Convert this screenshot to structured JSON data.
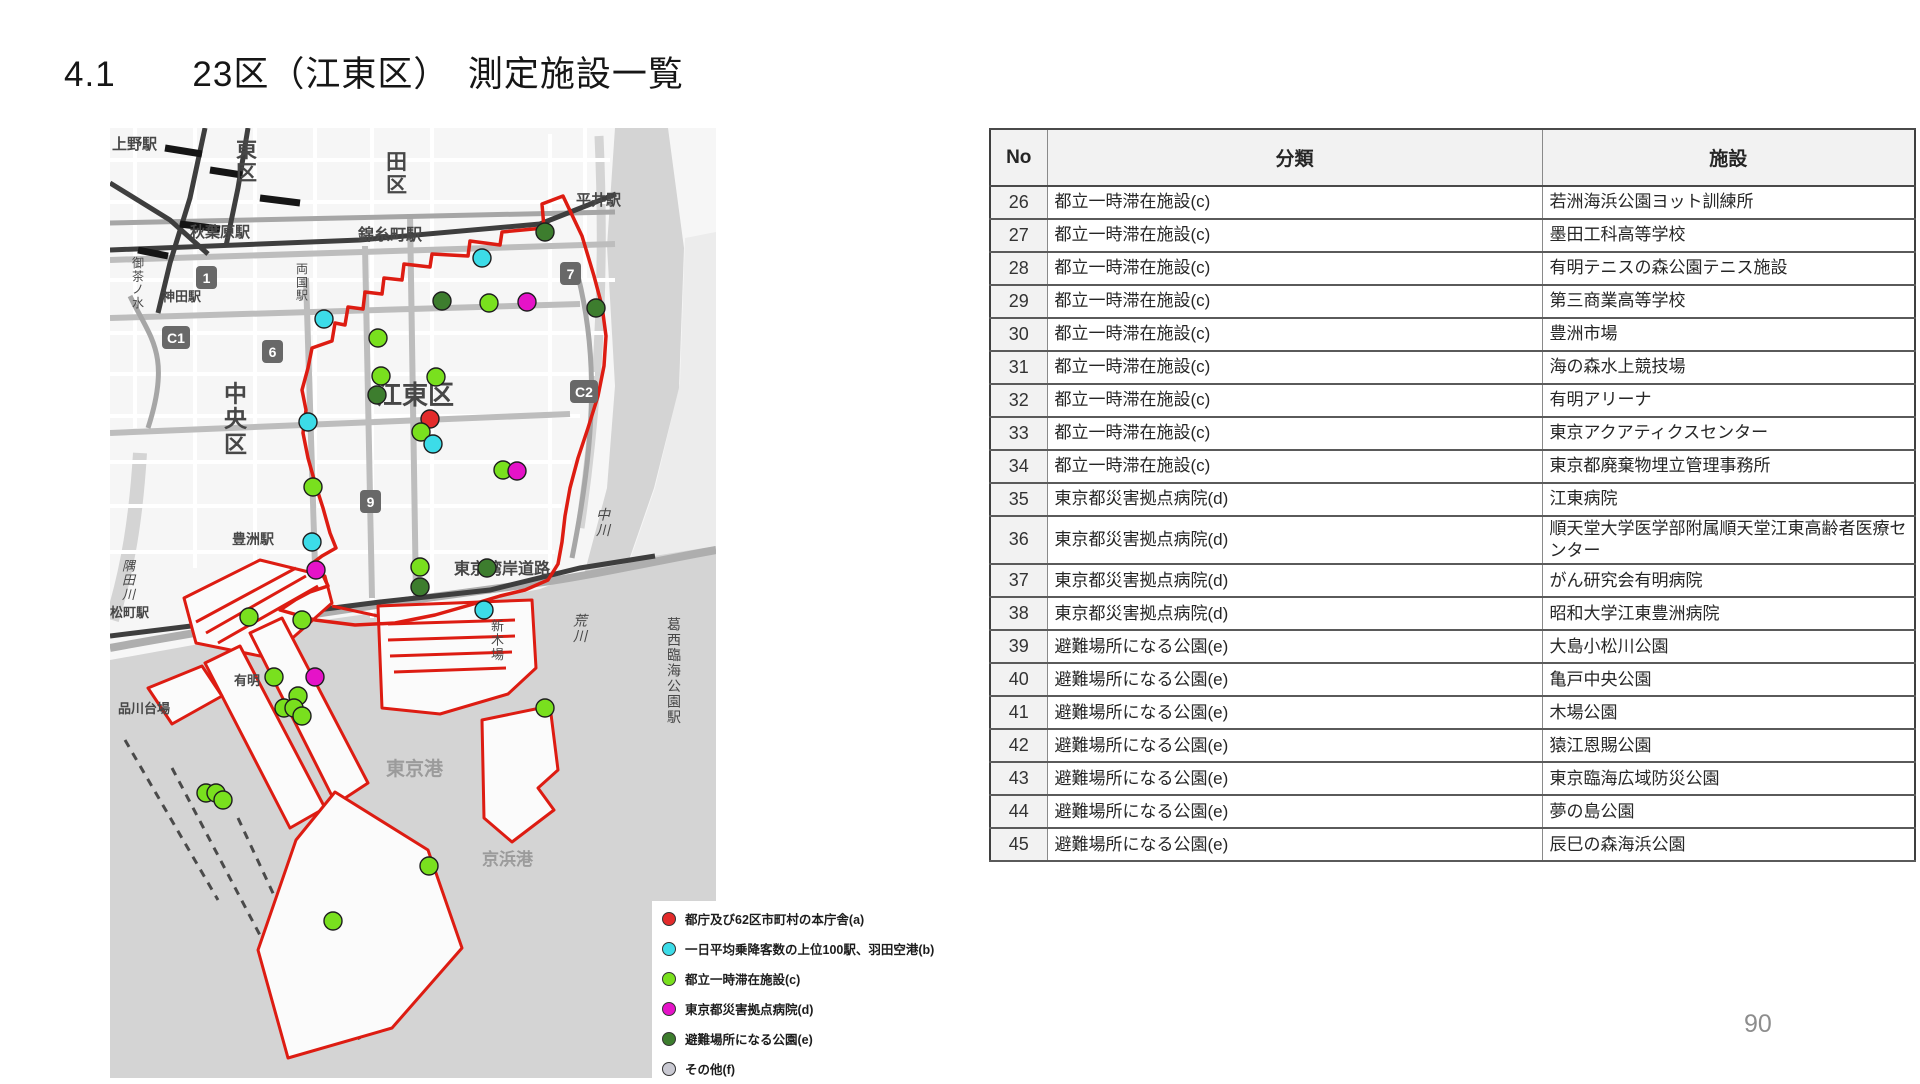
{
  "header": {
    "section_number": "4.1",
    "title": "23区（江東区）　測定施設一覧"
  },
  "page_number": "90",
  "table": {
    "headers": {
      "no": "No",
      "category": "分類",
      "facility": "施設"
    },
    "rows": [
      {
        "no": "26",
        "category": "都立一時滞在施設(c)",
        "facility": "若洲海浜公園ヨット訓練所"
      },
      {
        "no": "27",
        "category": "都立一時滞在施設(c)",
        "facility": "墨田工科高等学校"
      },
      {
        "no": "28",
        "category": "都立一時滞在施設(c)",
        "facility": "有明テニスの森公園テニス施設"
      },
      {
        "no": "29",
        "category": "都立一時滞在施設(c)",
        "facility": "第三商業高等学校"
      },
      {
        "no": "30",
        "category": "都立一時滞在施設(c)",
        "facility": "豊洲市場"
      },
      {
        "no": "31",
        "category": "都立一時滞在施設(c)",
        "facility": "海の森水上競技場"
      },
      {
        "no": "32",
        "category": "都立一時滞在施設(c)",
        "facility": "有明アリーナ"
      },
      {
        "no": "33",
        "category": "都立一時滞在施設(c)",
        "facility": "東京アクアティクスセンター"
      },
      {
        "no": "34",
        "category": "都立一時滞在施設(c)",
        "facility": "東京都廃棄物埋立管理事務所"
      },
      {
        "no": "35",
        "category": "東京都災害拠点病院(d)",
        "facility": "江東病院"
      },
      {
        "no": "36",
        "category": "東京都災害拠点病院(d)",
        "facility": "順天堂大学医学部附属順天堂江東高齢者医療センター"
      },
      {
        "no": "37",
        "category": "東京都災害拠点病院(d)",
        "facility": "がん研究会有明病院"
      },
      {
        "no": "38",
        "category": "東京都災害拠点病院(d)",
        "facility": "昭和大学江東豊洲病院"
      },
      {
        "no": "39",
        "category": "避難場所になる公園(e)",
        "facility": "大島小松川公園"
      },
      {
        "no": "40",
        "category": "避難場所になる公園(e)",
        "facility": "亀戸中央公園"
      },
      {
        "no": "41",
        "category": "避難場所になる公園(e)",
        "facility": "木場公園"
      },
      {
        "no": "42",
        "category": "避難場所になる公園(e)",
        "facility": "猿江恩賜公園"
      },
      {
        "no": "43",
        "category": "避難場所になる公園(e)",
        "facility": "東京臨海広域防災公園"
      },
      {
        "no": "44",
        "category": "避難場所になる公園(e)",
        "facility": "夢の島公園"
      },
      {
        "no": "45",
        "category": "避難場所になる公園(e)",
        "facility": "辰巳の森海浜公園"
      }
    ]
  },
  "legend": {
    "items": [
      {
        "key": "a",
        "label": "都庁及び62区市町村の本庁舎(a)",
        "color": "#e32b2b"
      },
      {
        "key": "b",
        "label": "一日平均乗降客数の上位100駅、羽田空港(b)",
        "color": "#3cdce8"
      },
      {
        "key": "c",
        "label": "都立一時滞在施設(c)",
        "color": "#79e01e"
      },
      {
        "key": "d",
        "label": "東京都災害拠点病院(d)",
        "color": "#e513c8"
      },
      {
        "key": "e",
        "label": "避難場所になる公園(e)",
        "color": "#3d7d2e"
      },
      {
        "key": "f",
        "label": "その他(f)",
        "color": "#c9c9d2"
      }
    ]
  },
  "map": {
    "ward_name": "江東区",
    "boundary_color": "#dd1c12",
    "markers": [
      {
        "type": "e",
        "x": 435,
        "y": 104
      },
      {
        "type": "b",
        "x": 372,
        "y": 130
      },
      {
        "type": "e",
        "x": 332,
        "y": 173
      },
      {
        "type": "c",
        "x": 379,
        "y": 175
      },
      {
        "type": "d",
        "x": 417,
        "y": 174
      },
      {
        "type": "e",
        "x": 486,
        "y": 180
      },
      {
        "type": "b",
        "x": 214,
        "y": 191
      },
      {
        "type": "c",
        "x": 268,
        "y": 210
      },
      {
        "type": "c",
        "x": 271,
        "y": 248
      },
      {
        "type": "c",
        "x": 326,
        "y": 249
      },
      {
        "type": "e",
        "x": 267,
        "y": 267
      },
      {
        "type": "a",
        "x": 320,
        "y": 291
      },
      {
        "type": "c",
        "x": 311,
        "y": 304
      },
      {
        "type": "b",
        "x": 323,
        "y": 316
      },
      {
        "type": "b",
        "x": 198,
        "y": 294
      },
      {
        "type": "c",
        "x": 393,
        "y": 342
      },
      {
        "type": "d",
        "x": 407,
        "y": 343
      },
      {
        "type": "c",
        "x": 203,
        "y": 359
      },
      {
        "type": "b",
        "x": 202,
        "y": 414
      },
      {
        "type": "d",
        "x": 206,
        "y": 442
      },
      {
        "type": "c",
        "x": 310,
        "y": 439
      },
      {
        "type": "e",
        "x": 377,
        "y": 440
      },
      {
        "type": "e",
        "x": 310,
        "y": 459
      },
      {
        "type": "b",
        "x": 374,
        "y": 482
      },
      {
        "type": "c",
        "x": 139,
        "y": 489
      },
      {
        "type": "c",
        "x": 192,
        "y": 492
      },
      {
        "type": "c",
        "x": 164,
        "y": 549
      },
      {
        "type": "d",
        "x": 205,
        "y": 549
      },
      {
        "type": "c",
        "x": 188,
        "y": 568
      },
      {
        "type": "c",
        "x": 174,
        "y": 580
      },
      {
        "type": "c",
        "x": 184,
        "y": 580
      },
      {
        "type": "c",
        "x": 192,
        "y": 588
      },
      {
        "type": "c",
        "x": 435,
        "y": 580
      },
      {
        "type": "c",
        "x": 96,
        "y": 665
      },
      {
        "type": "c",
        "x": 106,
        "y": 665
      },
      {
        "type": "c",
        "x": 113,
        "y": 672
      },
      {
        "type": "c",
        "x": 319,
        "y": 738
      },
      {
        "type": "c",
        "x": 223,
        "y": 793
      }
    ],
    "labels": [
      {
        "text": "上野駅",
        "x": 2,
        "y": 6,
        "size": 15,
        "bold": true
      },
      {
        "text": "東区",
        "x": 126,
        "y": 6,
        "size": 21,
        "vertical": true,
        "bold": true
      },
      {
        "text": "田区",
        "x": 276,
        "y": 18,
        "size": 21,
        "vertical": true,
        "bold": true
      },
      {
        "text": "平井駅",
        "x": 466,
        "y": 62,
        "size": 15,
        "bold": true
      },
      {
        "text": "秋葉原駅",
        "x": 80,
        "y": 94,
        "size": 15,
        "bold": true
      },
      {
        "text": "錦糸町駅",
        "x": 248,
        "y": 96,
        "size": 16,
        "bold": true
      },
      {
        "text": "御茶ノ水",
        "x": 22,
        "y": 126,
        "size": 12,
        "vertical": true
      },
      {
        "text": "両国駅",
        "x": 186,
        "y": 132,
        "size": 12,
        "vertical": true
      },
      {
        "text": "神田駅",
        "x": 52,
        "y": 160,
        "size": 13,
        "bold": true
      },
      {
        "text": "中央区",
        "x": 114,
        "y": 248,
        "size": 23,
        "vertical": true,
        "bold": true
      },
      {
        "text": "江東区",
        "x": 266,
        "y": 250,
        "size": 26,
        "bold": true
      },
      {
        "text": "豊洲駅",
        "x": 122,
        "y": 402,
        "size": 14,
        "bold": true
      },
      {
        "text": "隅田川",
        "x": 12,
        "y": 428,
        "size": 13,
        "vertical": true,
        "italic": true
      },
      {
        "text": "松町駅",
        "x": 0,
        "y": 476,
        "size": 13,
        "bold": true
      },
      {
        "text": "東京湾岸道路",
        "x": 344,
        "y": 430,
        "size": 16,
        "bold": true
      },
      {
        "text": "新木場",
        "x": 381,
        "y": 488,
        "size": 13,
        "vertical": true
      },
      {
        "text": "有明",
        "x": 124,
        "y": 544,
        "size": 13,
        "bold": true
      },
      {
        "text": "品川台場",
        "x": 8,
        "y": 572,
        "size": 13,
        "bold": true
      },
      {
        "text": "中川",
        "x": 486,
        "y": 376,
        "size": 14,
        "vertical": true,
        "italic": true
      },
      {
        "text": "荒川",
        "x": 463,
        "y": 482,
        "size": 14,
        "vertical": true,
        "italic": true
      },
      {
        "text": "葛西臨海公園駅",
        "x": 557,
        "y": 486,
        "size": 14,
        "vertical": true
      },
      {
        "text": "東京港",
        "x": 276,
        "y": 628,
        "size": 19,
        "bold": true,
        "color": "#9b9b9b"
      },
      {
        "text": "京浜港",
        "x": 372,
        "y": 720,
        "size": 17,
        "bold": true,
        "color": "#9b9b9b"
      }
    ],
    "shields": [
      {
        "text": "1",
        "x": 86,
        "y": 138
      },
      {
        "text": "6",
        "x": 152,
        "y": 212
      },
      {
        "text": "7",
        "x": 450,
        "y": 134
      },
      {
        "text": "9",
        "x": 250,
        "y": 362
      },
      {
        "text": "C1",
        "x": 52,
        "y": 198
      },
      {
        "text": "C2",
        "x": 460,
        "y": 252
      }
    ]
  }
}
